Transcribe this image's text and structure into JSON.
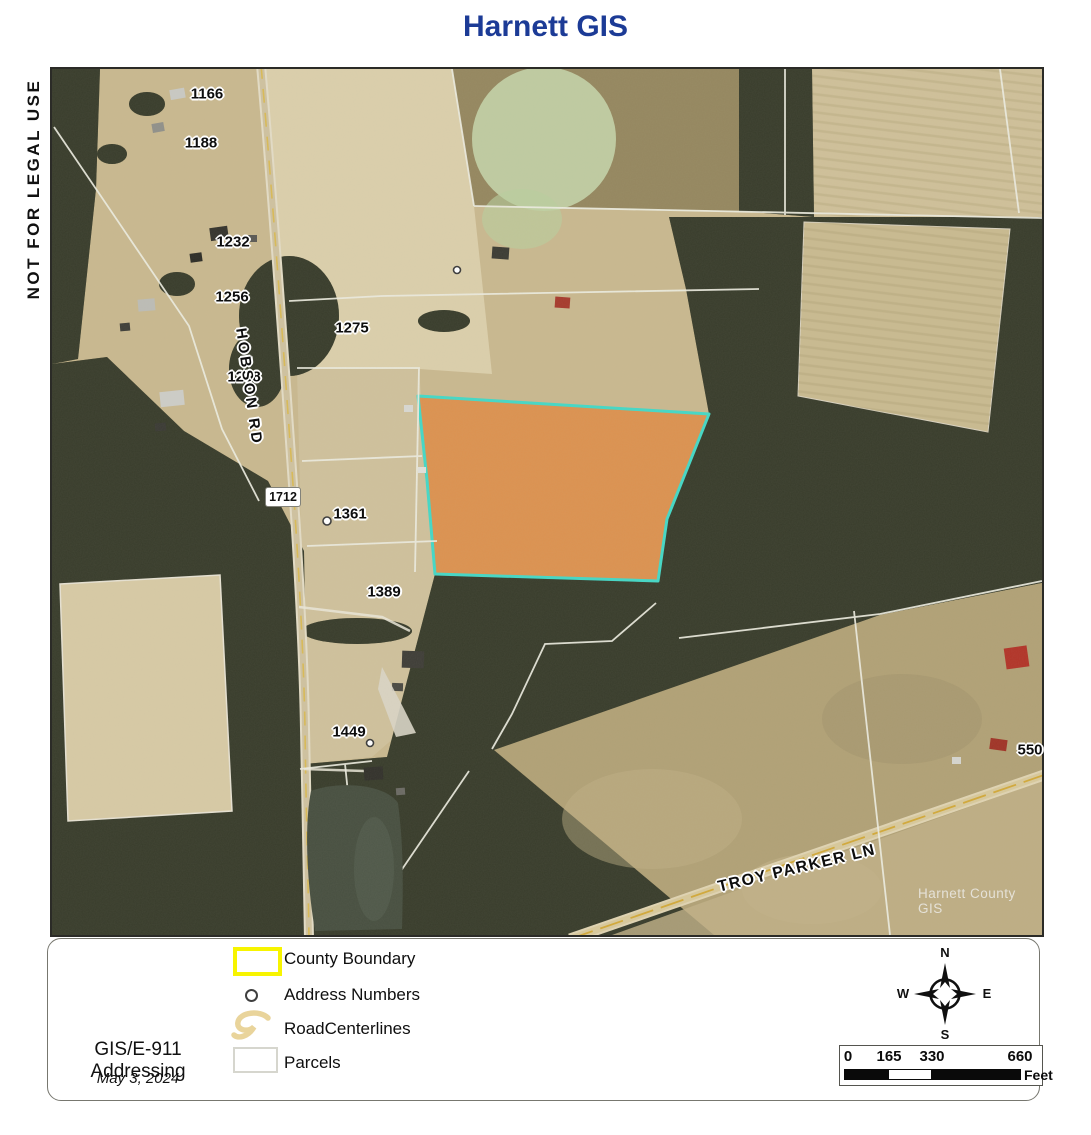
{
  "title": "Harnett GIS",
  "disclaimer": "NOT FOR LEGAL USE",
  "map": {
    "watermark": "Harnett County GIS",
    "route_shield": "1712",
    "road_labels": {
      "hobson": "HOBSON RD",
      "troy_parker": "TROY PARKER LN"
    },
    "address_labels": [
      {
        "text": "1166"
      },
      {
        "text": "1188"
      },
      {
        "text": "1232"
      },
      {
        "text": "1256"
      },
      {
        "text": "1275"
      },
      {
        "text": "1288"
      },
      {
        "text": "1361"
      },
      {
        "text": "1389"
      },
      {
        "text": "1449"
      },
      {
        "text": "550"
      }
    ]
  },
  "legend": {
    "items": [
      {
        "key": "county-boundary",
        "label": "County Boundary"
      },
      {
        "key": "address-numbers",
        "label": "Address Numbers"
      },
      {
        "key": "road-centerlines",
        "label": "RoadCenterlines"
      },
      {
        "key": "parcels",
        "label": "Parcels"
      }
    ],
    "department": "GIS/E-911 Addressing",
    "date": "May 3, 2024"
  },
  "compass": {
    "north": "N",
    "east": "E",
    "south": "S",
    "west": "W"
  },
  "scale_bar": {
    "ticks": [
      "0",
      "165",
      "330",
      "660"
    ],
    "unit": "Feet"
  },
  "colors": {
    "title_blue": "#1c3b96",
    "parcel_highlight_orange": "#df8b45",
    "parcel_outline_cyan": "#44d8c6",
    "county_boundary_yellow": "#f7f400"
  }
}
